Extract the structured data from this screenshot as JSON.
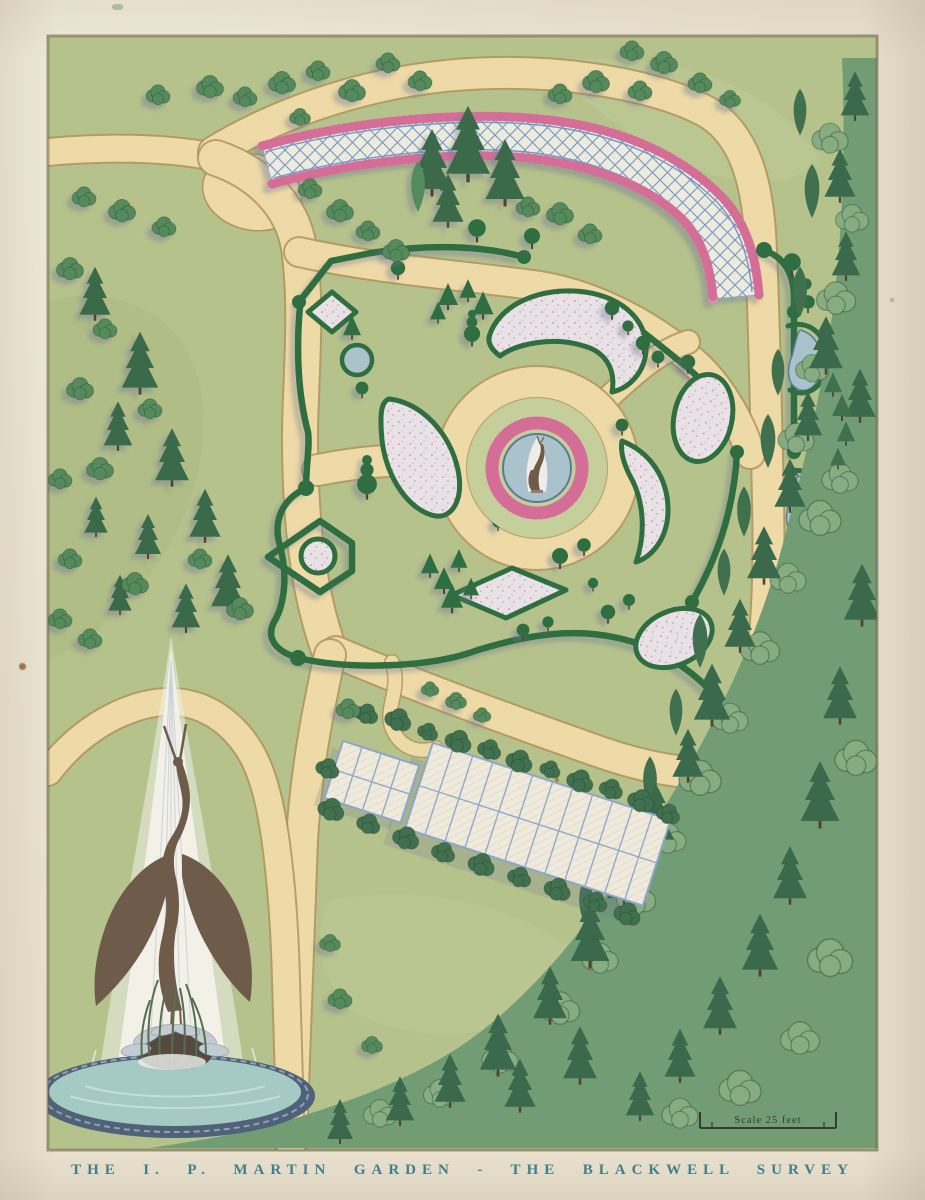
{
  "artwork": {
    "caption": "THE I. P. MARTIN GARDEN - THE BLACKWELL SURVEY",
    "scale_label": "Scale 25 feet"
  },
  "features": {
    "trellis_walk": "curved lattice trellis walk bordered with pink flowers",
    "parterre_garden": "hedge-enclosed formal parterre with shaped beds and topiary",
    "central_pool": "circular pool ringed by pink flowers and a walk",
    "heron_statue": "heron fountain statue in central pool",
    "border_walk": "east border walk with hedge, topiary and teardrop ponds",
    "greenhouse": "glass greenhouse range surrounded by shrubs",
    "heron_fountain": "large heron fountain with tall water plume",
    "fountain_basin": "oval ornamented fountain basin",
    "woodland": "dense woodland along right and bottom edges",
    "scale_bar": "drawn scale bar"
  },
  "palette": {
    "paper": "#e9e1ce",
    "lawn": "#b6c28c",
    "lawn_light": "#c4cf9c",
    "lawn_dark": "#a9b780",
    "path": "#eedaa6",
    "path_edge": "#b2945e",
    "hedge": "#2f6e40",
    "hedge_light": "#5b9455",
    "conifer": "#3a6a4b",
    "bush": "#558a5c",
    "forest": "#729c73",
    "forest_dark": "#41704f",
    "forest_light": "#88ac82",
    "bed": "#e8e1e6",
    "flower_pink": "#e787ad",
    "flower_deep": "#c2557f",
    "water": "#a9c2cc",
    "water_edge": "#5b7d92",
    "basin_water": "#a5c9c3",
    "basin_rim": "#4f6277",
    "lattice_fill": "#edebdd",
    "lattice_line": "#7496c3",
    "glass": "#efeadc",
    "glass_line": "#8aa7c9",
    "statue": "#6e5b49",
    "plume": "#f4f2ea",
    "shadow": "#6d7894",
    "caption": "#417f8d",
    "scale_ink": "#3a3a33",
    "speck": "#8a5a28"
  }
}
